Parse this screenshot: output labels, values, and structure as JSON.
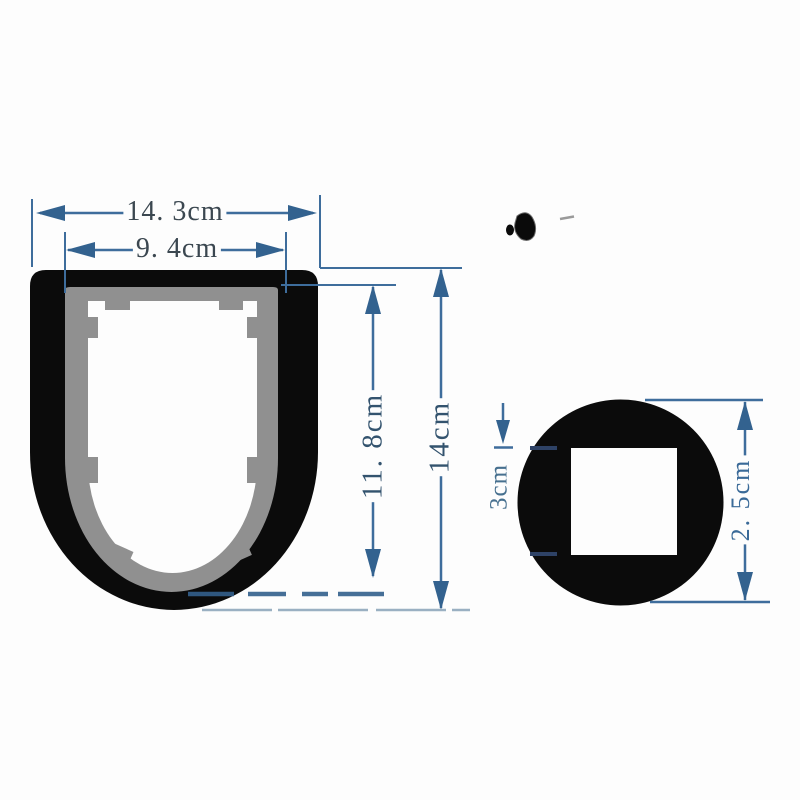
{
  "image_type": "product-dimension-diagram",
  "colors": {
    "background": "#fdfdfd",
    "profile_black": "#0b0b0b",
    "profile_gray": "#909090",
    "cavity_white": "#fdfdfd",
    "dimension_line": "#3e6d9c",
    "dimension_text_dark": "#3b4750",
    "dimension_text_blue": "#33536e",
    "tick_navy": "#2e4266"
  },
  "u_profile": {
    "shape": "U-channel cross-section, black outer wall, gray inner liner, white cavity with tabs",
    "labels": {
      "outer_width": "14. 3cm",
      "inner_width": "9. 4cm",
      "inner_height": "11. 8cm",
      "outer_height": "14cm"
    }
  },
  "round_profile": {
    "shape": "black circle end-view with white square hole",
    "labels": {
      "square_hole": "3cm",
      "outer_height": "2. 5cm"
    }
  }
}
